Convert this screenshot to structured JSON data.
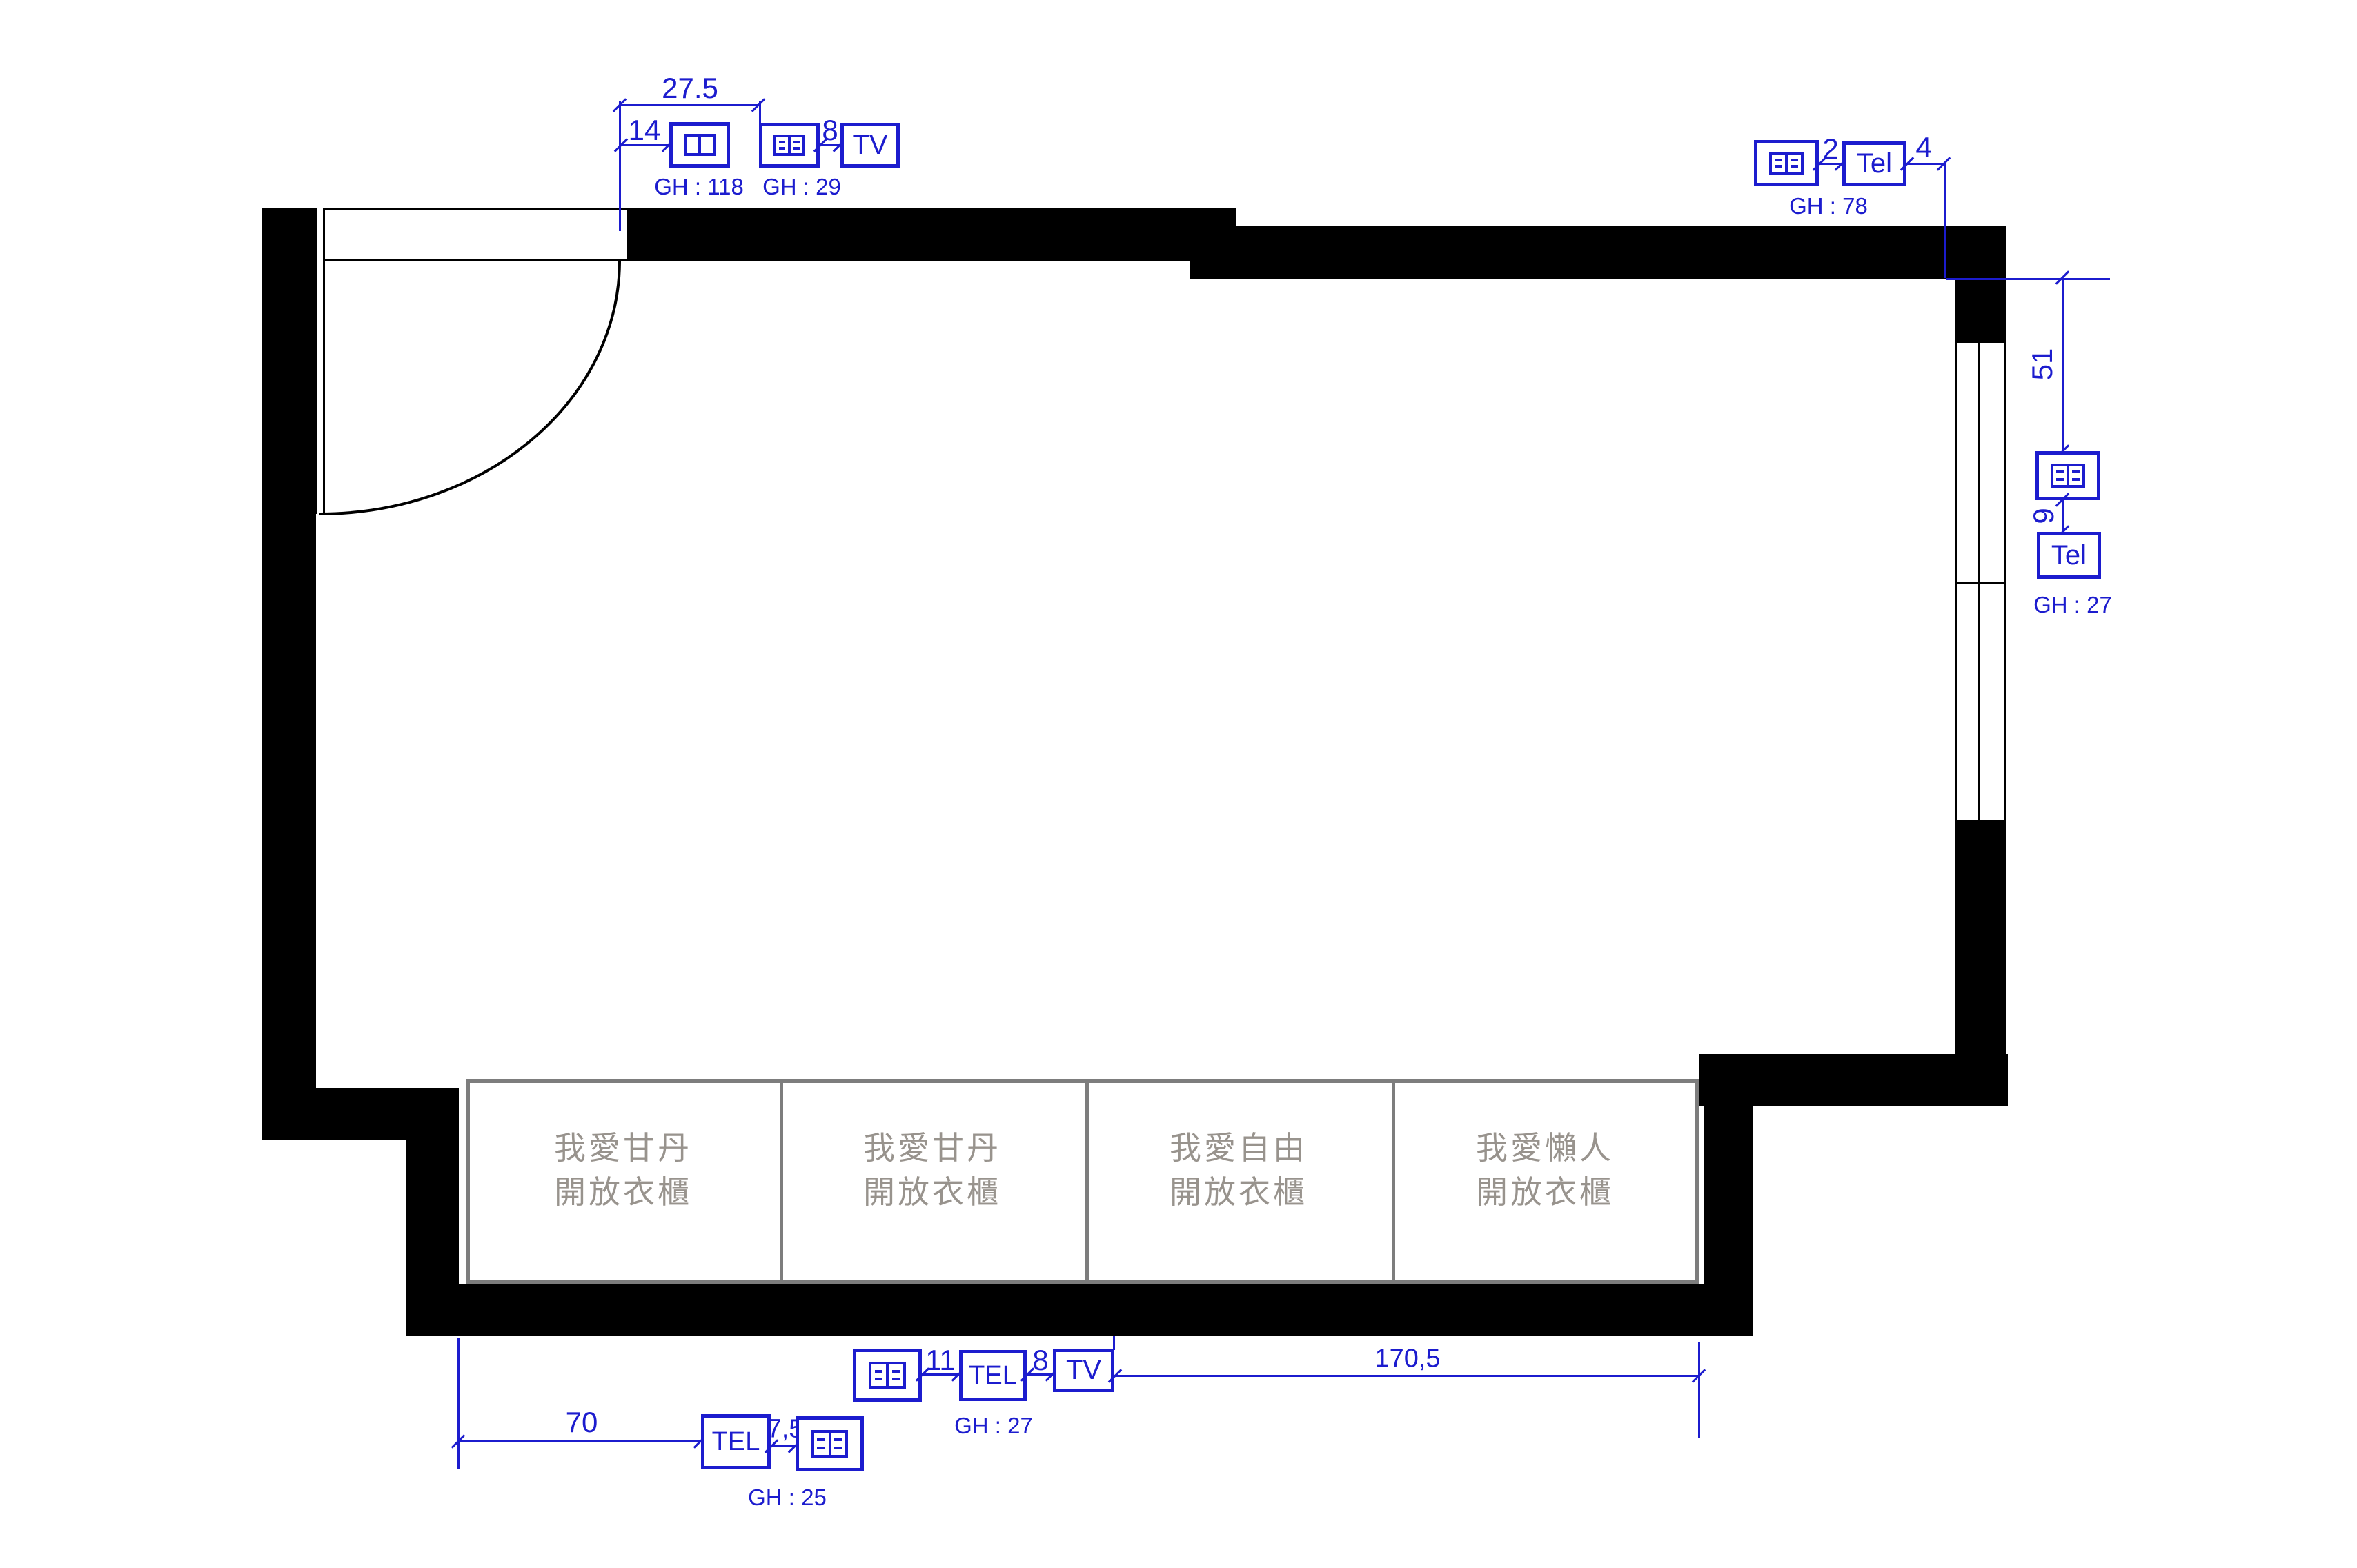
{
  "drawing_type": "floor-plan with electrical outlet annotations",
  "colors": {
    "annotation_blue": "#1c1cce",
    "wall_black": "#000000",
    "wardrobe_text_gray": "#98938d",
    "wardrobe_border_gray": "#7d7d7d"
  },
  "wardrobes": [
    {
      "line1": "我愛甘丹",
      "line2": "開放衣櫃"
    },
    {
      "line1": "我愛甘丹",
      "line2": "開放衣櫃"
    },
    {
      "line1": "我愛自由",
      "line2": "開放衣櫃"
    },
    {
      "line1": "我愛懶人",
      "line2": "開放衣櫃"
    }
  ],
  "annotations": {
    "top_left": {
      "dim_overall": "27.5",
      "dim_offset": "14",
      "outlet_gh": "GH : 118",
      "dim_gap": "8",
      "tv_label": "TV",
      "tv_outlet_gh": "GH : 29"
    },
    "top_right": {
      "dim_gap": "2",
      "tel_label": "Tel",
      "dim_end": "4",
      "outlet_gh": "GH : 78"
    },
    "right_wall": {
      "dim_down": "51",
      "dim_gap": "9",
      "tel_label": "Tel",
      "outlet_gh": "GH : 27"
    },
    "bottom_wall": {
      "dim_gap1": "11",
      "tel_label": "TEL",
      "tel_gh": "GH : 27",
      "dim_gap2": "8",
      "tv_label": "TV",
      "dim_span": "170,5"
    },
    "bottom_left": {
      "dim_span": "70",
      "tel_label": "TEL",
      "dim_gap": "7,5",
      "outlet_gh": "GH : 25"
    }
  }
}
